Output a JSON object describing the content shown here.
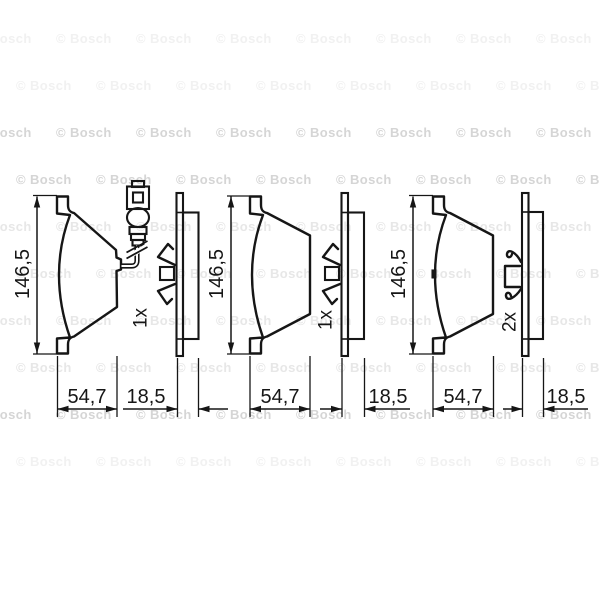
{
  "watermark": {
    "text": "© Bosch"
  },
  "drawings": [
    {
      "name": "brake-pad-with-wear-sensor",
      "height": "146,5",
      "width": "54,7",
      "thickness": "18,5",
      "quantity": "1x"
    },
    {
      "name": "brake-pad-plain",
      "height": "146,5",
      "width": "54,7",
      "thickness": "18,5",
      "quantity": "1x"
    },
    {
      "name": "brake-pad-with-clip",
      "height": "146,5",
      "width": "54,7",
      "thickness": "18,5",
      "quantity": "2x"
    }
  ]
}
